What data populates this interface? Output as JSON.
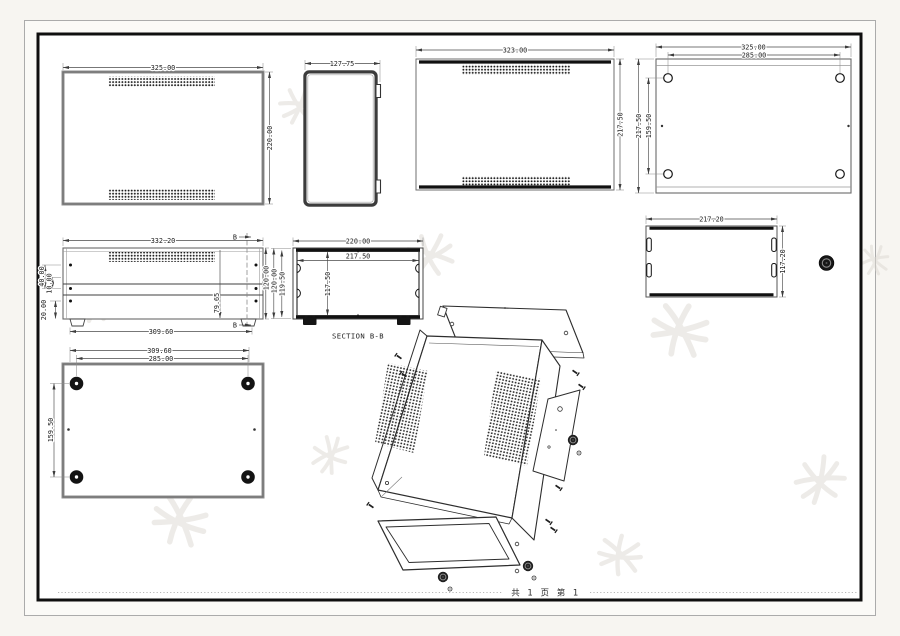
{
  "sheet": {
    "footer": "共 1 页  第 1"
  },
  "front_view": {
    "width": "325.00",
    "height": "220.00"
  },
  "side_view": {
    "width": "127.75"
  },
  "top_view": {
    "width": "323.00",
    "height": "217.50"
  },
  "bottom_view": {
    "width": "325.00",
    "hole_span_width": "285.00",
    "height": "217.50",
    "hole_span_height": "159.50"
  },
  "rear_view": {
    "width": "332.20",
    "bracket_depth": "40.00",
    "offset": "10.00",
    "foot_height": "20.00",
    "vent_offset": "79.65",
    "base_width": "309.60",
    "height": "120.00",
    "section_marker": "B"
  },
  "section_view": {
    "label": "SECTION B-B",
    "outer_width": "220.00",
    "inner_width": "217.50",
    "inner_height": "117.50",
    "outer_height": "120.00",
    "wall_height": "119.50"
  },
  "cover_view": {
    "width": "217.20",
    "height": "117.20"
  },
  "base_view": {
    "width": "309.60",
    "hole_span_width": "285.00",
    "hole_span_height": "159.50"
  }
}
